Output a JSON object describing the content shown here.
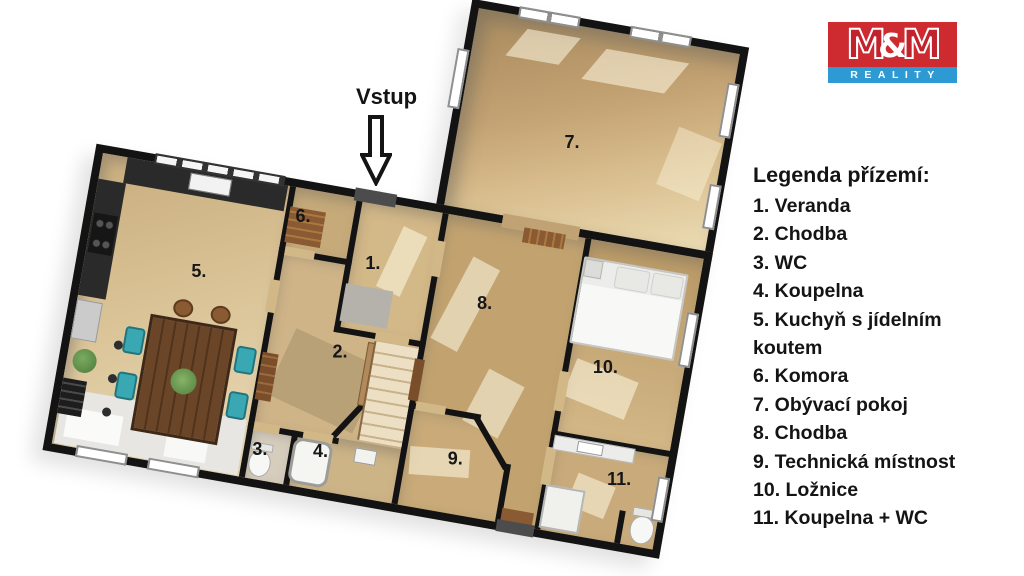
{
  "brand": {
    "m1": "M",
    "ampersand": "&",
    "m2": "M",
    "subtitle": "REALITY",
    "red": "#ce2b31",
    "blue": "#2e9ad3"
  },
  "entrance": {
    "label": "Vstup"
  },
  "legend": {
    "title": "Legenda přízemí:",
    "items": [
      "1. Veranda",
      "2. Chodba",
      "3. WC",
      "4. Koupelna",
      "5. Kuchyň s jídelním\nkoutem",
      "6. Komora",
      "7. Obývací pokoj",
      "8. Chodba",
      "9. Technická místnost",
      "10. Ložnice",
      "11. Koupelna + WC"
    ]
  },
  "plan": {
    "wall_color": "#131313",
    "floor_light": "#e9dab6",
    "floor_dark": "#b99966",
    "rooms": [
      {
        "number": "1.",
        "name": "Veranda"
      },
      {
        "number": "2.",
        "name": "Chodba"
      },
      {
        "number": "3.",
        "name": "WC"
      },
      {
        "number": "4.",
        "name": "Koupelna"
      },
      {
        "number": "5.",
        "name": "Kuchyň s jídelním koutem"
      },
      {
        "number": "6.",
        "name": "Komora"
      },
      {
        "number": "7.",
        "name": "Obývací pokoj"
      },
      {
        "number": "8.",
        "name": "Chodba"
      },
      {
        "number": "9.",
        "name": "Technická místnost"
      },
      {
        "number": "10.",
        "name": "Ložnice"
      },
      {
        "number": "11.",
        "name": "Koupelna + WC"
      }
    ]
  }
}
